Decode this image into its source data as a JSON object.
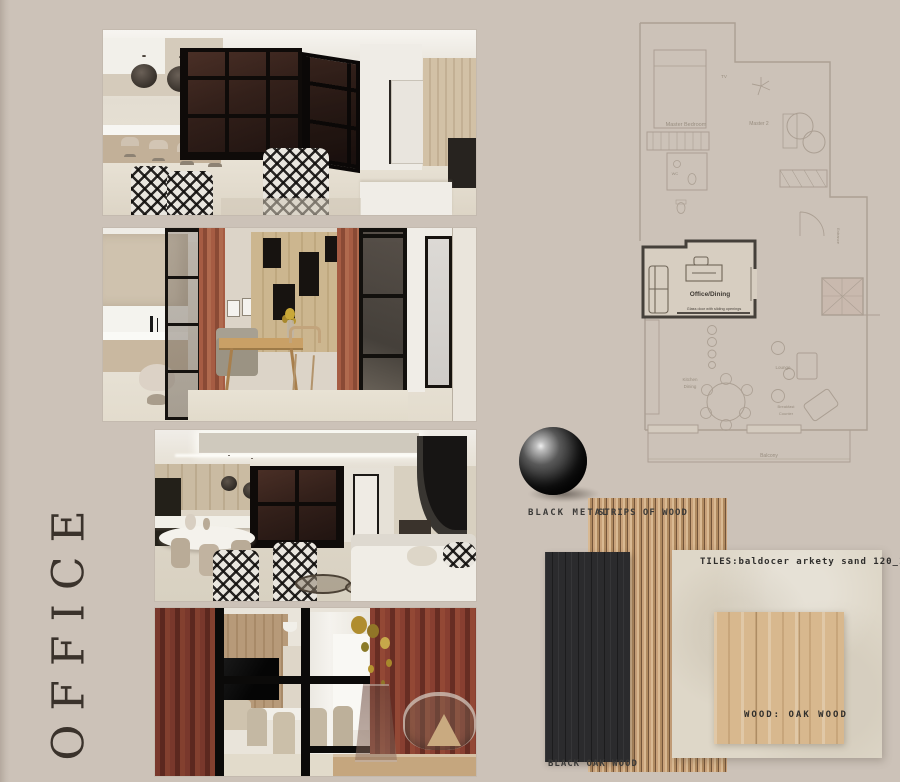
{
  "page": {
    "title": "OFFICE",
    "background_color": "#ccc2b8"
  },
  "materials": {
    "black_metal_label": "BLACK METAL",
    "strips_of_wood_label": "STRIPS OF WOOD",
    "black_oak_wood_label": "BLACK OAK WOOD",
    "tiles_label": "TILES:baldocer arkety sand 120_120",
    "oak_wood_label": "WOOD: OAK WOOD",
    "colors": {
      "black_metal": "#141414",
      "wood_strip_light": "#d9b992",
      "wood_strip_dark": "#74553a",
      "black_oak": "#2b2b2d",
      "tile_sand": "#ded7c8",
      "oak_wood": "#d8b88e",
      "rust_curtain": "#8a4a35"
    }
  },
  "floor_plan": {
    "office_room": {
      "label": "Office/Dining",
      "note": "Glass door with sliding openings"
    },
    "room_labels": {
      "master_bedroom": "Master Bedroom",
      "master_2": "Master 2",
      "tv": "TV",
      "wc": "WC",
      "kitchen_line1": "Kitchen",
      "kitchen_line2": "Dining",
      "lounge": "Lounge",
      "breakfast_line1": "Breakfast",
      "breakfast_line2": "Counter",
      "balcony": "Balcony",
      "entrance": "Entrance"
    }
  }
}
